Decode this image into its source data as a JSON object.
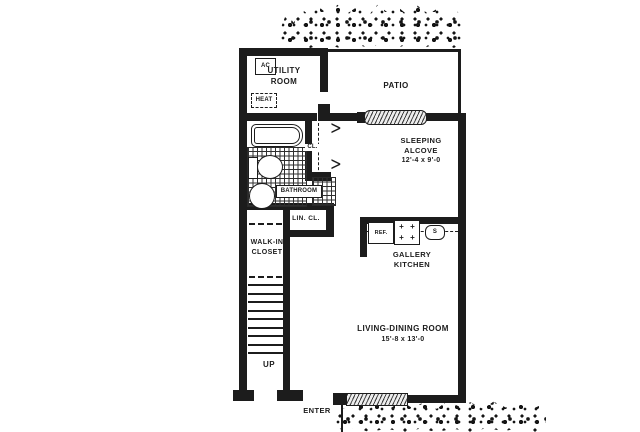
{
  "colors": {
    "ink": "#1c1c1c",
    "paper": "#ffffff"
  },
  "icons": {
    "door_fold": ">",
    "burner": "+"
  },
  "rooms": {
    "utility": {
      "line1": "UTILITY",
      "line2": "ROOM"
    },
    "patio": {
      "label": "PATIO"
    },
    "sleeping_alcove": {
      "line1": "SLEEPING",
      "line2": "ALCOVE",
      "dims": "12'-4 x 9'-0"
    },
    "closet": {
      "label": "CL."
    },
    "bathroom": {
      "label": "BATHROOM"
    },
    "linen_closet": {
      "label": "LIN. CL."
    },
    "walk_in_closet": {
      "line1": "WALK-IN",
      "line2": "CLOSET"
    },
    "kitchen": {
      "line1": "GALLERY",
      "line2": "KITCHEN"
    },
    "living_dining": {
      "label": "LIVING-DINING ROOM",
      "dims": "15'-8 x 13'-0"
    }
  },
  "fixtures": {
    "ac": "AC",
    "heat": "HEAT",
    "refrigerator": "REF.",
    "sink": "S"
  },
  "annotations": {
    "up": "UP",
    "enter": "ENTER"
  }
}
